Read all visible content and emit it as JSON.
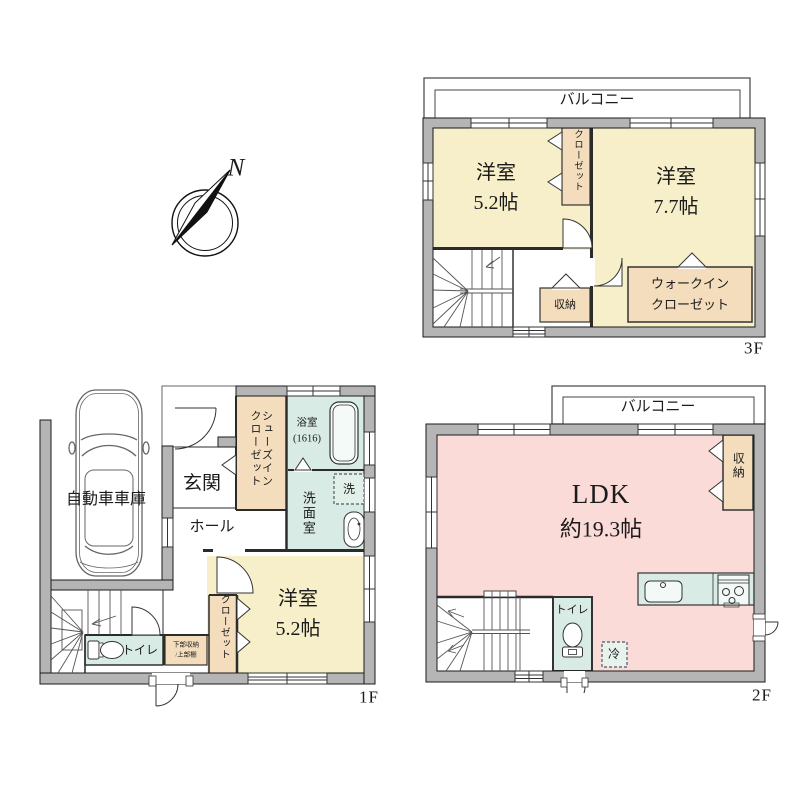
{
  "compass": {
    "north": "N"
  },
  "floor3f": {
    "name": "3F",
    "balcony": "バルコニー",
    "room_small": "洋室\n5.2帖",
    "room_large": "洋室\n7.7帖",
    "closet": "クローゼット",
    "storage": "収納",
    "walk_in_closet": "ウォークイン\nクローゼット"
  },
  "floor1f": {
    "name": "1F",
    "garage": "自動車車庫",
    "entrance": "玄関",
    "hall": "ホール",
    "shoes_closet": "シューズインクローゼット",
    "bathroom": "浴室\n(1616)",
    "washroom": "洗面室",
    "washer": "洗",
    "room": "洋室\n5.2帖",
    "closet": "クローゼット",
    "toilet": "トイレ",
    "storage_note": "下部収納\n/上部棚"
  },
  "floor2f": {
    "name": "2F",
    "balcony": "バルコニー",
    "ldk": "LDK",
    "ldk_size": "約19.3帖",
    "storage": "収納",
    "toilet": "トイレ",
    "fridge": "冷"
  },
  "colors": {
    "room_cream": "#f6efc9",
    "closet_tan": "#f3ddbd",
    "ldk_pink": "#fadbd7",
    "wet_teal": "#d8ebe5",
    "fridge_green": "#e7f3ec",
    "wall_gray": "#b5b5b5"
  }
}
